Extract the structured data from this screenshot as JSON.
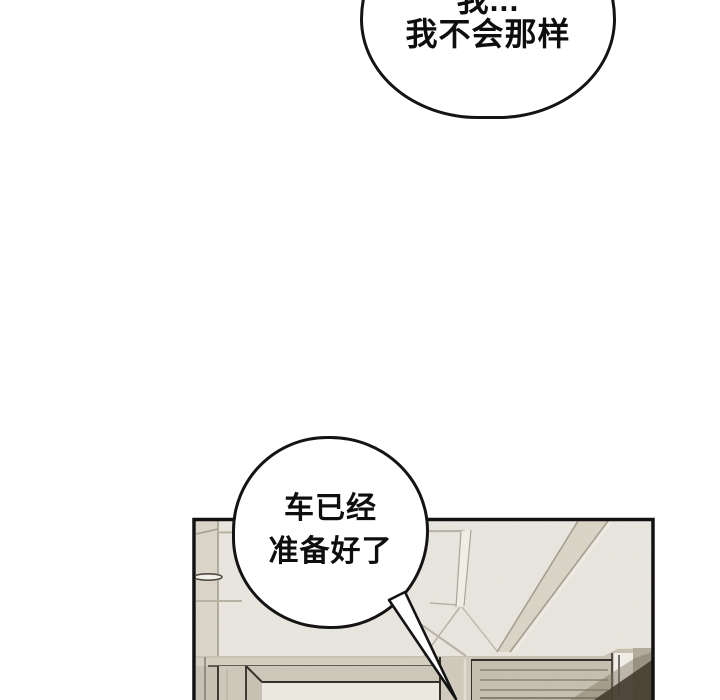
{
  "page": {
    "background": "#ffffff",
    "outline_color": "#141414"
  },
  "speech_bubbles": {
    "top": {
      "line1": "我...",
      "line2": "我不会那样",
      "fill": "#ffffff"
    },
    "bottom": {
      "line1": "车已经",
      "line2": "准备好了",
      "fill": "#ffffff"
    }
  },
  "panel": {
    "description": "interior scene: ceiling with diagonal beam, doorway and slatted cabinet",
    "colors": {
      "ceiling": "#eae8e0",
      "ceiling_left_strip": "#dcd7ca",
      "ceiling_line": "#b5af9f",
      "highlight": "#f4f1ea",
      "beam": "#dbd6c8",
      "beam_edge": "#a59f90",
      "wall": "#c9c3b5",
      "wall_band": "#d6d1c3",
      "door_face": "#cfc9bb",
      "door_opening": "#efece4",
      "post": "#d2ccbe",
      "shelf": "#c7c1b1",
      "shelf_line": "#87816f",
      "right_wall": "#b3ac9d",
      "shadow_mid": "#7a7060",
      "shadow_dark": "#42382d",
      "fixture_fill": "#f7f5ef"
    }
  }
}
